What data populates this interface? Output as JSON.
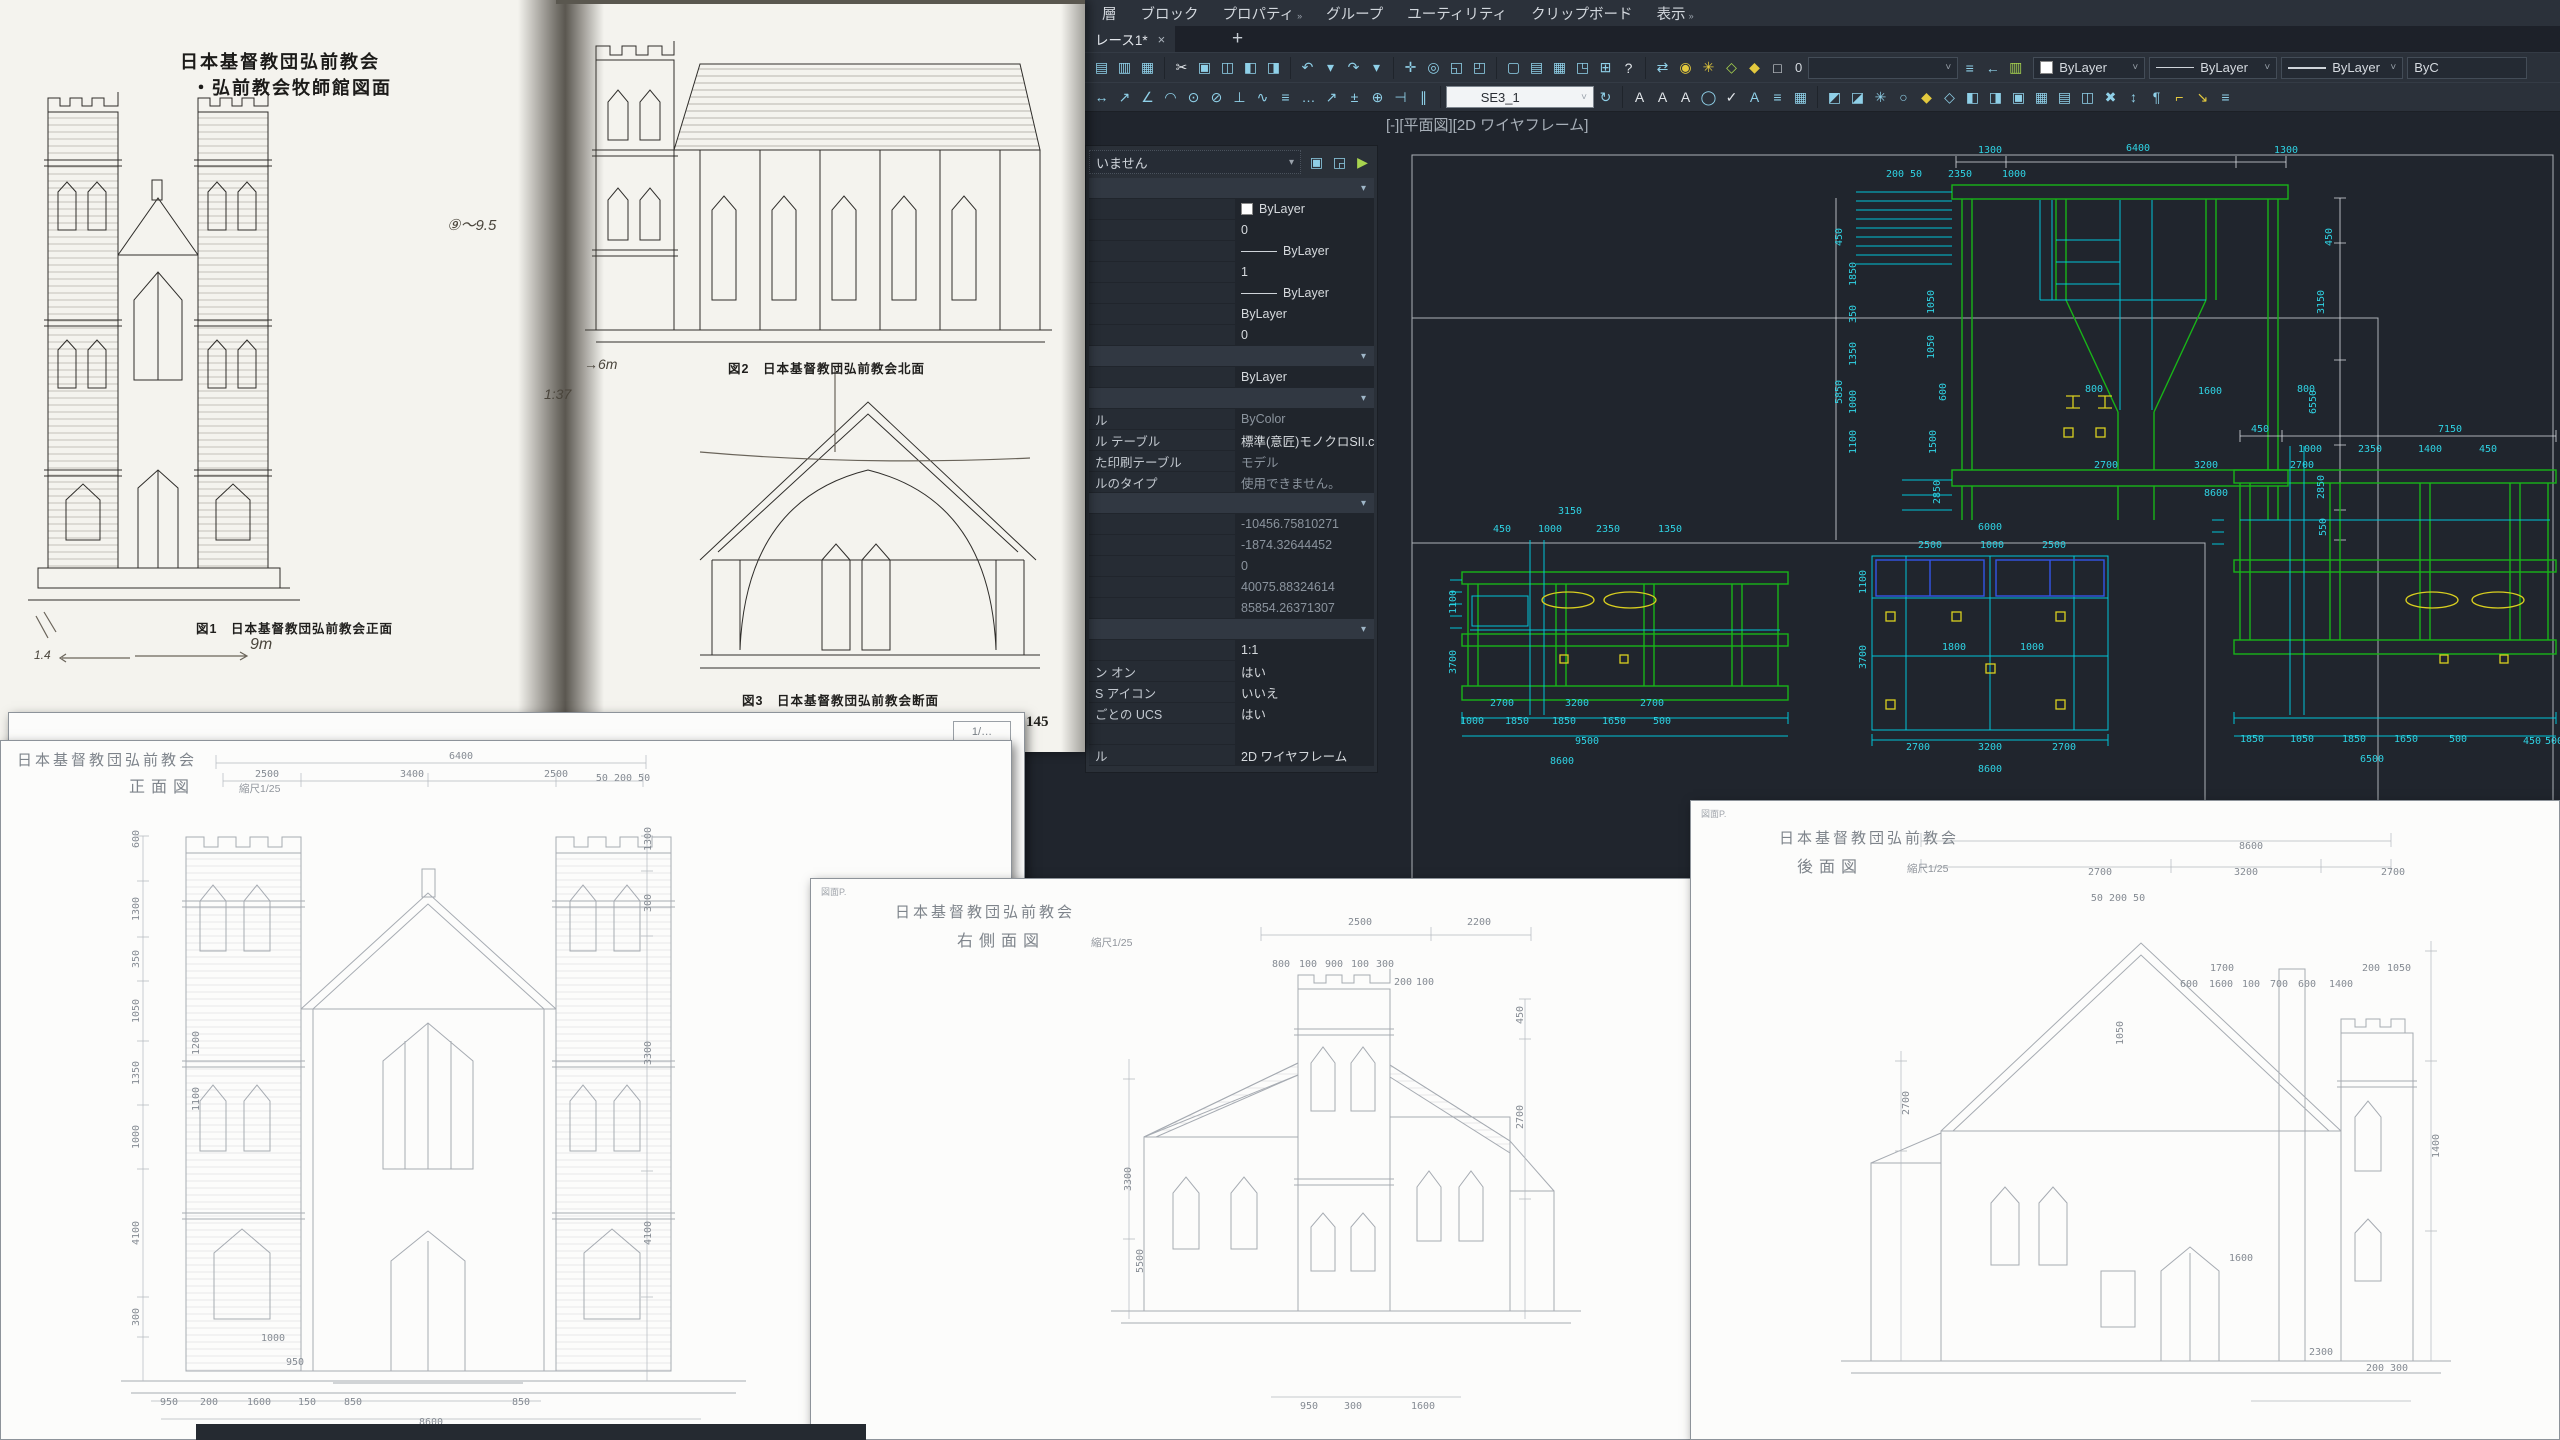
{
  "colors": {
    "canvas_bg": "#20252d",
    "chrome": "#2b313a",
    "cad_green": "#18b418",
    "cad_cyan": "#00c4d6",
    "cad_yellow": "#d9cf1f",
    "cad_blue": "#3355e8",
    "cad_white": "#d9dde2"
  },
  "scan": {
    "title1": "日本基督教団弘前教会",
    "title2": "・弘前教会牧師館図面",
    "fig1": "図1　日本基督教団弘前教会正面",
    "fig2": "図2　日本基督教団弘前教会北面",
    "fig3": "図3　日本基督教団弘前教会断面",
    "page": "145",
    "notes": [
      [
        447,
        214,
        "⑨〜9.5",
        15
      ],
      [
        544,
        386,
        "1:37",
        14
      ],
      [
        584,
        356,
        "→6m",
        14
      ],
      [
        250,
        636,
        "9m",
        16
      ],
      [
        34,
        648,
        "1.4",
        12
      ]
    ]
  },
  "acad": {
    "menu": [
      {
        "t": "層"
      },
      {
        "t": "ブロック"
      },
      {
        "t": "プロパティ",
        "c": "»"
      },
      {
        "t": "グループ"
      },
      {
        "t": "ユーティリティ"
      },
      {
        "t": "クリップボード"
      },
      {
        "t": "表示",
        "c": "»"
      }
    ],
    "tab": {
      "title": "レース1*",
      "close": "×",
      "add": "+"
    },
    "vplabel": "[-][平面図][2D ワイヤフレーム]",
    "tb1": {
      "layer_value": "0",
      "color": "ByLayer",
      "ltype": "ByLayer",
      "lweight": "ByLayer",
      "plot": "ByC"
    },
    "tb2": {
      "dimstyle": "SE3_1"
    },
    "icons": {
      "g1": [
        "printer-icon",
        "plot-preview-icon",
        "publish-icon"
      ],
      "g2": [
        "cut-icon",
        "copy-icon",
        "paste-icon",
        "match-properties-icon",
        "block-editor-icon"
      ],
      "g3": [
        "undo-icon",
        "caret-down-icon",
        "redo-icon",
        "caret-down-icon"
      ],
      "g4": [
        "pan-icon",
        "zoom-realtime-icon",
        "zoom-window-icon",
        "zoom-previous-icon"
      ],
      "g5": [
        "model-space-icon",
        "layout-icon",
        "sheet-set-icon",
        "viewport-icon",
        "calculator-icon",
        "help-icon"
      ],
      "g6": [
        "etransmit-icon"
      ],
      "g7": [
        "bulb-icon",
        "sun-icon",
        "annotation-frame-icon",
        "unlock-icon",
        "isolate-icon"
      ],
      "g8": [
        "layer-stack-icon",
        "layer-previous-icon",
        "layer-settings-icon"
      ],
      "d1": [
        "linear-dim-icon",
        "aligned-dim-icon",
        "angular-dim-icon",
        "arc-length-dim-icon",
        "radius-dim-icon",
        "diameter-dim-icon",
        "ordinate-dim-icon",
        "jogged-dim-icon",
        "baseline-dim-icon",
        "continue-dim-icon",
        "leader-icon",
        "tolerance-icon",
        "center-mark-icon",
        "dim-break-icon",
        "dim-space-icon"
      ],
      "d2": [
        "dim-update-icon"
      ],
      "d3": [
        "text-icon",
        "text-underline-icon",
        "text-style-icon",
        "find-replace-icon",
        "spell-check-icon",
        "text-scale-icon",
        "text-justify-icon",
        "table-icon"
      ],
      "d4": [
        "layer-isolate-icon",
        "layer-unisolate-icon",
        "layer-freeze-icon",
        "layer-off-icon",
        "layer-lock-icon",
        "layer-unlock-icon",
        "layer-match-icon",
        "change-to-current-layer-icon",
        "copy-to-layer-icon",
        "layer-walk-icon",
        "vp-freeze-icon",
        "layer-merge-icon",
        "layer-delete-icon",
        "move-text-icon",
        "annotation-icon",
        "ruler-icon",
        "scale-icon",
        "list-icon"
      ],
      "sel": [
        "quick-select-icon",
        "select-objects-icon",
        "toggle-pickadd-icon"
      ]
    },
    "props": {
      "selector": "いません",
      "rows": [
        {
          "h": 1
        },
        {
          "v": "ByLayer",
          "sw": 1
        },
        {
          "v": "0"
        },
        {
          "v": "ByLayer",
          "ln": 1
        },
        {
          "v": "1"
        },
        {
          "v": "ByLayer",
          "ln": 1
        },
        {
          "v": "ByLayer"
        },
        {
          "v": "0"
        },
        {
          "h": 1
        },
        {
          "v": "ByLayer"
        },
        {
          "h": 1
        },
        {
          "l": "ル",
          "v": "ByColor",
          "d": 1
        },
        {
          "l": "ル テーブル",
          "v": "標準(意匠)モノクロSII.ctb"
        },
        {
          "l": "た印刷テーブル",
          "v": "モデル",
          "d": 1
        },
        {
          "l": "ルのタイプ",
          "v": "使用できません。",
          "d": 1
        },
        {
          "h": 1
        },
        {
          "v": "-10456.75810271",
          "d": 1
        },
        {
          "v": "-1874.32644452",
          "d": 1
        },
        {
          "v": "0",
          "d": 1
        },
        {
          "v": "40075.88324614",
          "d": 1
        },
        {
          "v": "85854.26371307",
          "d": 1
        },
        {
          "h": 1
        },
        {
          "v": "1:1"
        },
        {
          "l": "ン オン",
          "v": "はい"
        },
        {
          "l": "S アイコン",
          "v": "いいえ"
        },
        {
          "l": "ごとの UCS",
          "v": "はい"
        },
        {
          "v": ""
        },
        {
          "l": "ル",
          "v": "2D ワイヤフレーム"
        }
      ]
    }
  },
  "canvas": {
    "dims": [
      [
        1990,
        153,
        "1300",
        0,
        1
      ],
      [
        2138,
        151,
        "6400",
        0,
        1
      ],
      [
        2286,
        153,
        "1300",
        0,
        1
      ],
      [
        1904,
        177,
        "200 50"
      ],
      [
        1960,
        177,
        "2350"
      ],
      [
        2014,
        177,
        "1000"
      ],
      [
        1842,
        237,
        "450",
        1,
        1
      ],
      [
        1856,
        274,
        "1850",
        1
      ],
      [
        1856,
        314,
        "350",
        1
      ],
      [
        1856,
        354,
        "1350",
        1
      ],
      [
        1842,
        392,
        "5850",
        1,
        1
      ],
      [
        1856,
        402,
        "1000",
        1
      ],
      [
        1856,
        442,
        "1100",
        1
      ],
      [
        1934,
        302,
        "1050",
        1
      ],
      [
        1934,
        347,
        "1050",
        1
      ],
      [
        1946,
        392,
        "600",
        1
      ],
      [
        1936,
        442,
        "1500",
        1
      ],
      [
        1940,
        492,
        "2850",
        1
      ],
      [
        2332,
        237,
        "450",
        1,
        1
      ],
      [
        2324,
        302,
        "3150",
        1,
        1
      ],
      [
        2316,
        402,
        "6550",
        1,
        1
      ],
      [
        2324,
        487,
        "2850",
        1,
        1
      ],
      [
        2326,
        527,
        "550",
        1,
        1
      ],
      [
        2094,
        392,
        "800"
      ],
      [
        2210,
        394,
        "1600"
      ],
      [
        2306,
        392,
        "800"
      ],
      [
        2106,
        468,
        "2700"
      ],
      [
        2206,
        468,
        "3200"
      ],
      [
        2302,
        468,
        "2700"
      ],
      [
        2216,
        496,
        "8600"
      ],
      [
        1570,
        514,
        "3150"
      ],
      [
        1502,
        532,
        "450"
      ],
      [
        1550,
        532,
        "1000"
      ],
      [
        1608,
        532,
        "2350"
      ],
      [
        1670,
        532,
        "1350"
      ],
      [
        1456,
        602,
        "1100",
        1
      ],
      [
        1456,
        662,
        "3700",
        1
      ],
      [
        1472,
        724,
        "1000"
      ],
      [
        1517,
        724,
        "1850"
      ],
      [
        1564,
        724,
        "1850"
      ],
      [
        1614,
        724,
        "1650"
      ],
      [
        1662,
        724,
        "500"
      ],
      [
        1502,
        706,
        "2700"
      ],
      [
        1577,
        706,
        "3200"
      ],
      [
        1652,
        706,
        "2700"
      ],
      [
        1587,
        744,
        "9500"
      ],
      [
        1562,
        764,
        "8600"
      ],
      [
        1990,
        530,
        "6000"
      ],
      [
        1930,
        548,
        "2500"
      ],
      [
        1992,
        548,
        "1000"
      ],
      [
        2054,
        548,
        "2500"
      ],
      [
        1866,
        582,
        "1100",
        1
      ],
      [
        1866,
        657,
        "3700",
        1
      ],
      [
        1954,
        650,
        "1800"
      ],
      [
        2032,
        650,
        "1000"
      ],
      [
        1918,
        750,
        "2700"
      ],
      [
        1990,
        750,
        "3200"
      ],
      [
        2064,
        750,
        "2700"
      ],
      [
        1990,
        772,
        "8600"
      ],
      [
        2260,
        432,
        "450",
        0,
        1
      ],
      [
        2450,
        432,
        "7150",
        0,
        1
      ],
      [
        2310,
        452,
        "1000"
      ],
      [
        2370,
        452,
        "2350"
      ],
      [
        2430,
        452,
        "1400"
      ],
      [
        2488,
        452,
        "450"
      ],
      [
        2252,
        742,
        "1850"
      ],
      [
        2302,
        742,
        "1050"
      ],
      [
        2354,
        742,
        "1850"
      ],
      [
        2406,
        742,
        "1650"
      ],
      [
        2458,
        742,
        "500"
      ],
      [
        2372,
        762,
        "6500"
      ],
      [
        2532,
        744,
        "450"
      ],
      [
        2554,
        744,
        "500"
      ]
    ]
  },
  "sheets": {
    "a_back": {
      "scale": "1/…"
    },
    "a": {
      "t1": "日本基督教団弘前教会",
      "t2": "正面図",
      "t3": "縮尺1/25",
      "dims": [
        [
          460,
          18,
          "6400"
        ],
        [
          266,
          36,
          "2500"
        ],
        [
          411,
          36,
          "3400"
        ],
        [
          555,
          36,
          "2500"
        ],
        [
          622,
          40,
          "50 200 50"
        ],
        [
          138,
          98,
          "600",
          1
        ],
        [
          138,
          168,
          "1300",
          1
        ],
        [
          138,
          218,
          "350",
          1
        ],
        [
          138,
          270,
          "1050",
          1
        ],
        [
          138,
          332,
          "1350",
          1
        ],
        [
          138,
          396,
          "1000",
          1
        ],
        [
          138,
          492,
          "4100",
          1
        ],
        [
          138,
          576,
          "300",
          1
        ],
        [
          198,
          302,
          "1200",
          1
        ],
        [
          198,
          358,
          "1100",
          1
        ],
        [
          650,
          98,
          "1300",
          1
        ],
        [
          650,
          162,
          "300",
          1
        ],
        [
          650,
          312,
          "3300",
          1
        ],
        [
          650,
          492,
          "4100",
          1
        ],
        [
          272,
          600,
          "1000"
        ],
        [
          294,
          624,
          "950"
        ],
        [
          168,
          664,
          "950"
        ],
        [
          208,
          664,
          "200"
        ],
        [
          258,
          664,
          "1600"
        ],
        [
          306,
          664,
          "150"
        ],
        [
          352,
          664,
          "850"
        ],
        [
          520,
          664,
          "850"
        ],
        [
          430,
          684,
          "8600"
        ]
      ]
    },
    "b": {
      "mark": "図面P.",
      "t1": "日本基督教団弘前教会",
      "t2": "右側面図",
      "t3": "縮尺1/25",
      "dims": [
        [
          549,
          46,
          "2500"
        ],
        [
          668,
          46,
          "2200"
        ],
        [
          470,
          88,
          "800"
        ],
        [
          497,
          88,
          "100"
        ],
        [
          523,
          88,
          "900"
        ],
        [
          549,
          88,
          "100"
        ],
        [
          574,
          88,
          "300"
        ],
        [
          592,
          106,
          "200"
        ],
        [
          614,
          106,
          "100"
        ],
        [
          712,
          136,
          "450",
          1
        ],
        [
          712,
          238,
          "2700",
          1
        ],
        [
          320,
          300,
          "3300",
          1
        ],
        [
          332,
          382,
          "5500",
          1
        ],
        [
          498,
          530,
          "950"
        ],
        [
          542,
          530,
          "300"
        ],
        [
          612,
          530,
          "1600"
        ]
      ]
    },
    "c": {
      "mark": "図面P.",
      "t1": "日本基督教団弘前教会",
      "t2": "後面図",
      "t3": "縮尺1/25",
      "dims": [
        [
          560,
          48,
          "8600"
        ],
        [
          409,
          74,
          "2700"
        ],
        [
          555,
          74,
          "3200"
        ],
        [
          702,
          74,
          "2700"
        ],
        [
          427,
          100,
          "50 200 50"
        ],
        [
          531,
          170,
          "1700"
        ],
        [
          498,
          186,
          "600"
        ],
        [
          530,
          186,
          "1600"
        ],
        [
          560,
          186,
          "100"
        ],
        [
          588,
          186,
          "700"
        ],
        [
          616,
          186,
          "600"
        ],
        [
          650,
          186,
          "1400"
        ],
        [
          680,
          170,
          "200"
        ],
        [
          708,
          170,
          "1050"
        ],
        [
          748,
          345,
          "1400",
          1
        ],
        [
          432,
          232,
          "1050",
          1
        ],
        [
          218,
          302,
          "2700",
          1
        ],
        [
          550,
          460,
          "1600"
        ],
        [
          630,
          554,
          "2300"
        ],
        [
          684,
          570,
          "200"
        ],
        [
          708,
          570,
          "300"
        ]
      ]
    }
  }
}
